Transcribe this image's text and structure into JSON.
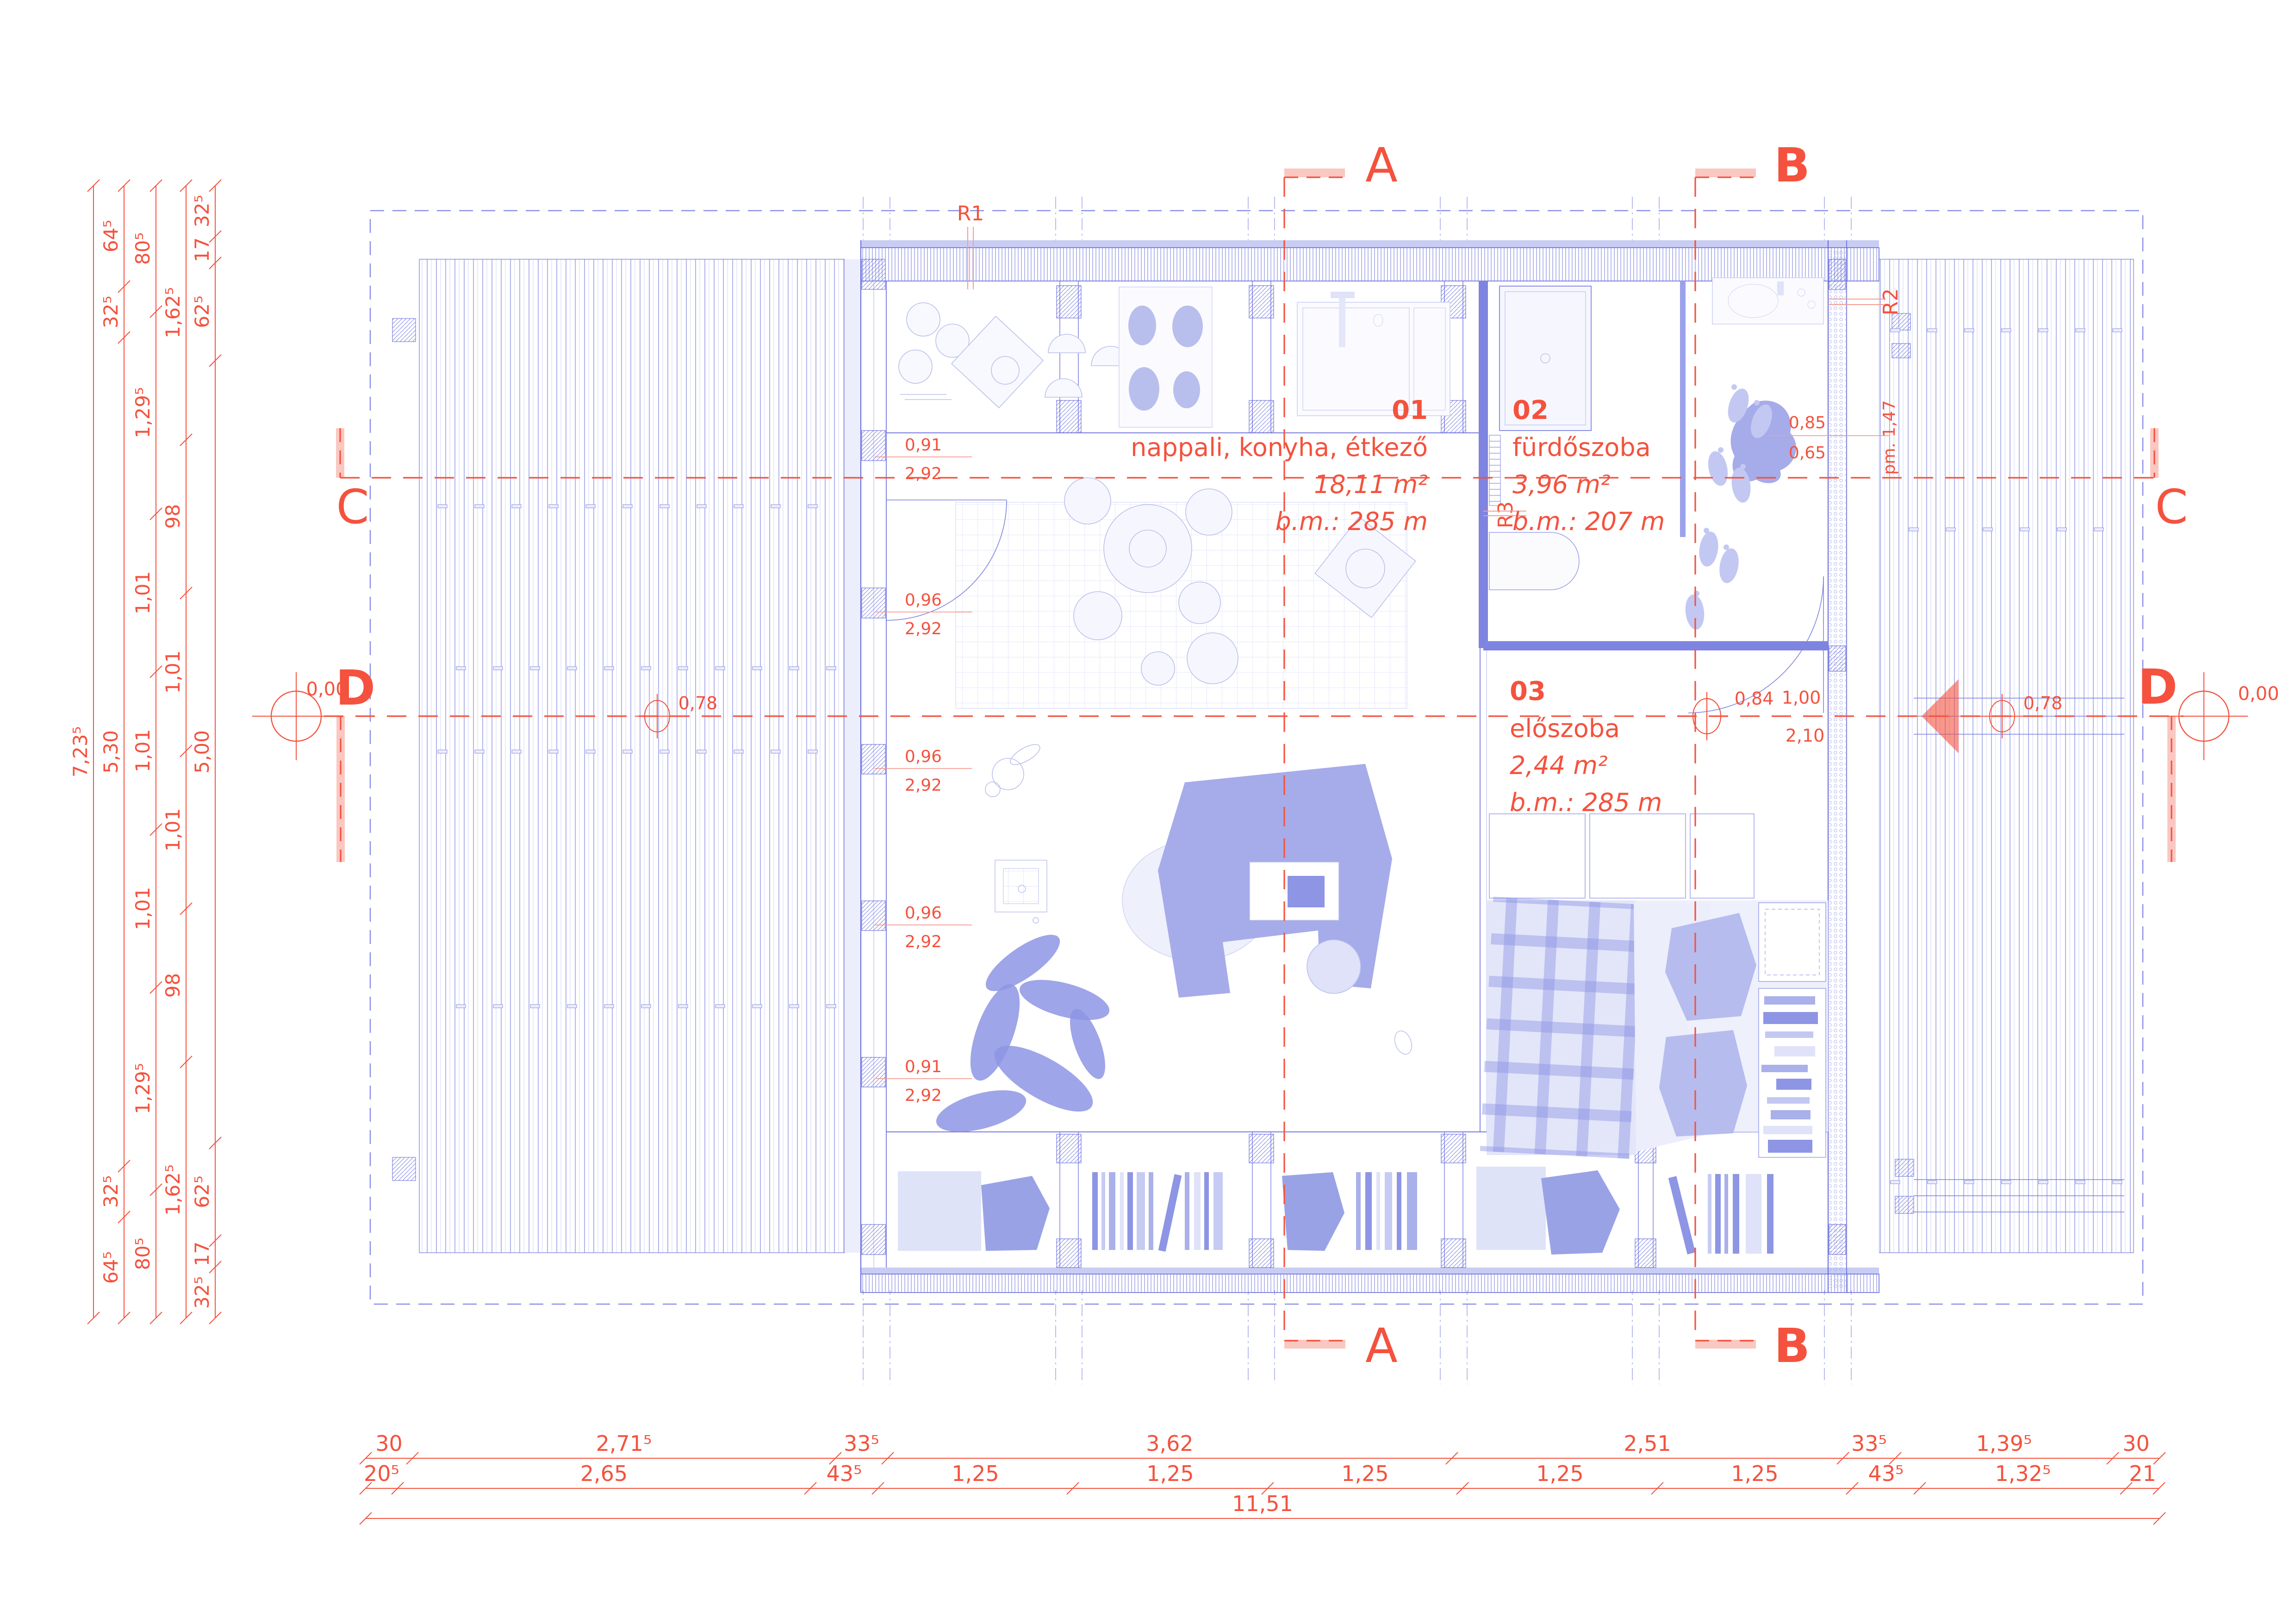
{
  "markers": {
    "a": "A",
    "b": "B",
    "c": "C",
    "d": "D"
  },
  "levels": {
    "zero_left": "0,00",
    "zero_right": "0,00",
    "deck_left": "0,78",
    "deck_right": "0,78",
    "hall": "0,84"
  },
  "door_dim": {
    "width": "1,00",
    "height": "2,10"
  },
  "refs": {
    "r1": "R1",
    "r2": "R2",
    "r3": "R3"
  },
  "note_pm": "pm. 1,47",
  "rooms": [
    {
      "num": "01",
      "name": "nappali, konyha, étkező",
      "area": "18,11 m²",
      "clear_height": "b.m.: 285 m"
    },
    {
      "num": "02",
      "name": "fürdőszoba",
      "area": "3,96 m²",
      "clear_height": "b.m.: 207 m"
    },
    {
      "num": "03",
      "name": "előszoba",
      "area": "2,44 m²",
      "clear_height": "b.m.: 285 m"
    }
  ],
  "window_dims": {
    "widths": [
      "0,91",
      "0,96",
      "0,96",
      "0,96",
      "0,91"
    ],
    "height": "2,92"
  },
  "bath_fixture_dims": {
    "width": "0,85",
    "depth": "0,65"
  },
  "dim_chains": {
    "left": [
      {
        "labels": [
          "7,23⁵"
        ]
      },
      {
        "labels": [
          "64⁵",
          "32⁵",
          "5,30",
          "32⁵",
          "64⁵"
        ]
      },
      {
        "labels": [
          "80⁵",
          "1,29⁵",
          "1,01",
          "1,01",
          "1,01",
          "1,29⁵",
          "80⁵"
        ]
      },
      {
        "labels": [
          "1,62⁵",
          "98",
          "1,01",
          "1,01",
          "98",
          "1,62⁵"
        ]
      },
      {
        "labels": [
          "32⁵",
          "17",
          "62⁵",
          "5,00",
          "62⁵",
          "17",
          "32⁵"
        ]
      }
    ],
    "bottom": [
      {
        "labels": [
          "30",
          "2,71⁵",
          "33⁵",
          "3,62",
          "2,51",
          "33⁵",
          "1,39⁵",
          "30"
        ]
      },
      {
        "labels": [
          "20⁵",
          "2,65",
          "43⁵",
          "1,25",
          "1,25",
          "1,25",
          "1,25",
          "1,25",
          "43⁵",
          "1,32⁵",
          "21"
        ]
      },
      {
        "labels": [
          "11,51"
        ]
      }
    ]
  },
  "colors": {
    "red": "#f4523e",
    "red_light": "#f59c92",
    "blue": "#6468da",
    "blue_mid": "#8a8fe8",
    "blue_light": "#b9bfec",
    "fill_light": "#dfe2f8",
    "furniture": "#a6abe9",
    "accent_dark": "#8d95e4"
  }
}
